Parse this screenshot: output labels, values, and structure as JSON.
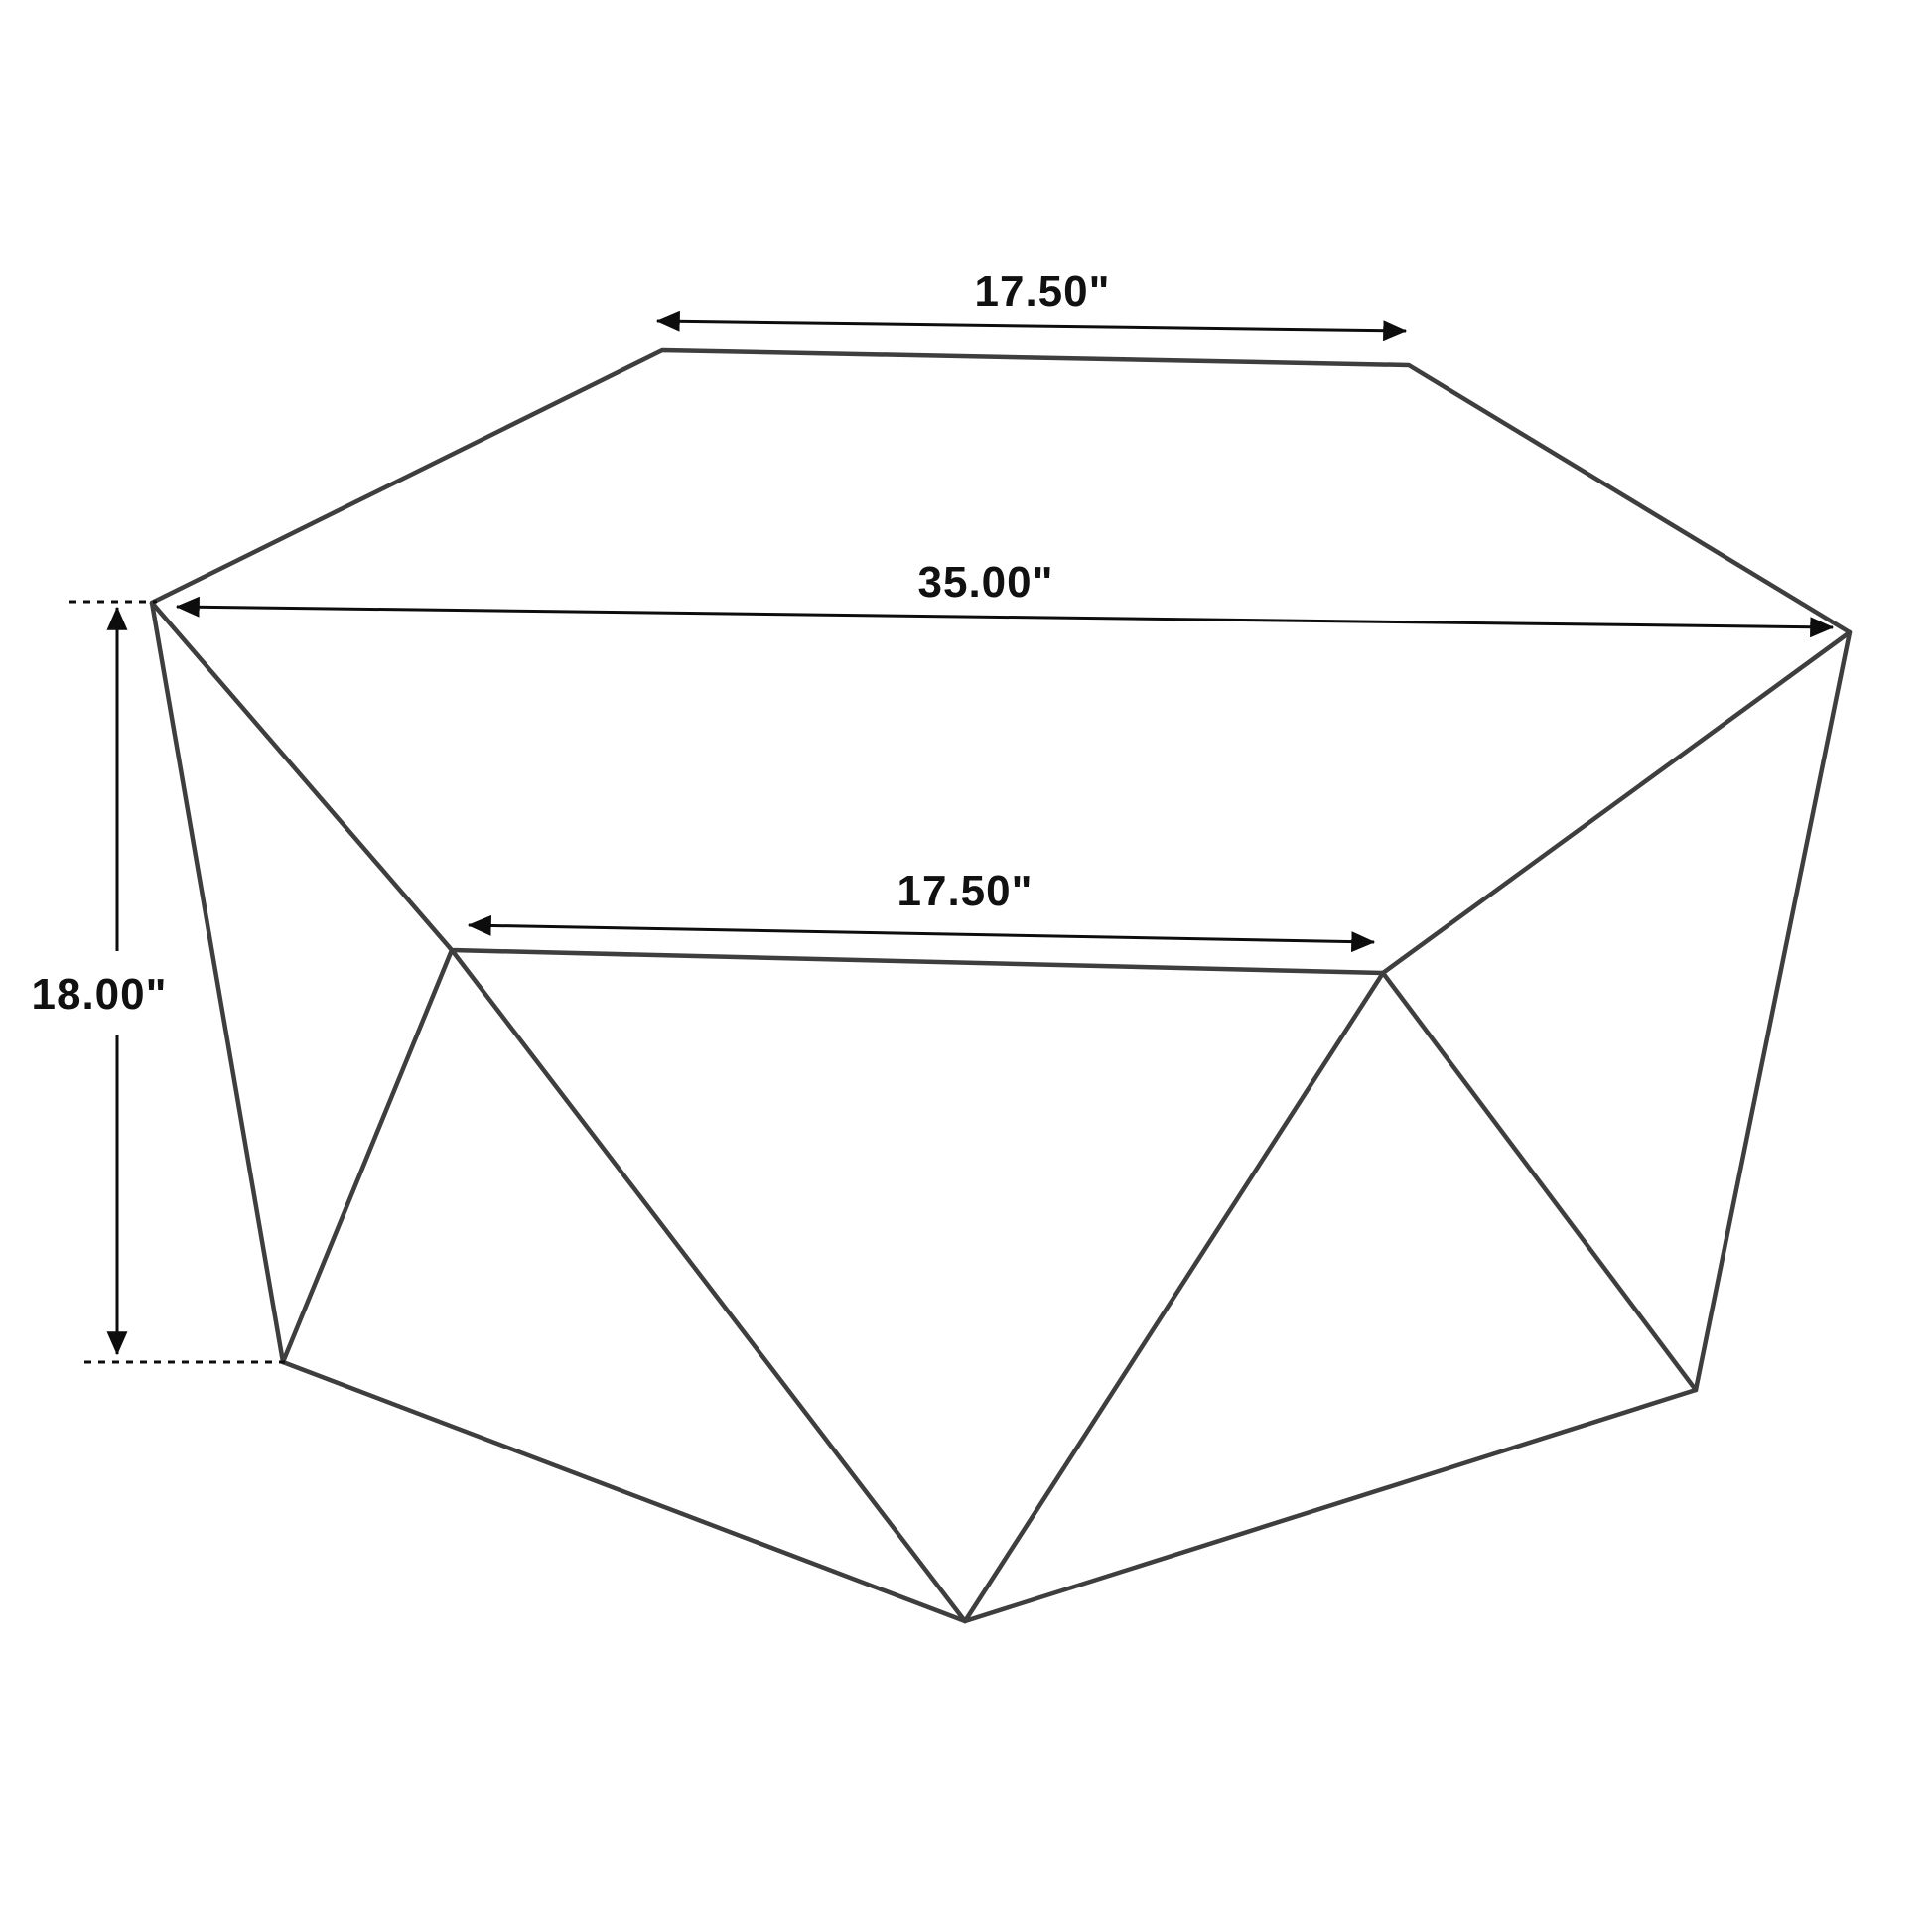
{
  "diagram": {
    "type": "furniture-dimension-diagram",
    "subject": "geometric-diamond-coffee-table",
    "labels": {
      "top_width": "17.50\"",
      "overall_width": "35.00\"",
      "front_width": "17.50\"",
      "height": "18.00\""
    }
  },
  "colors": {
    "background": "#ffffff",
    "edge": "#3e3e3e",
    "dimension": "#0d0d0d",
    "text": "#111111"
  }
}
